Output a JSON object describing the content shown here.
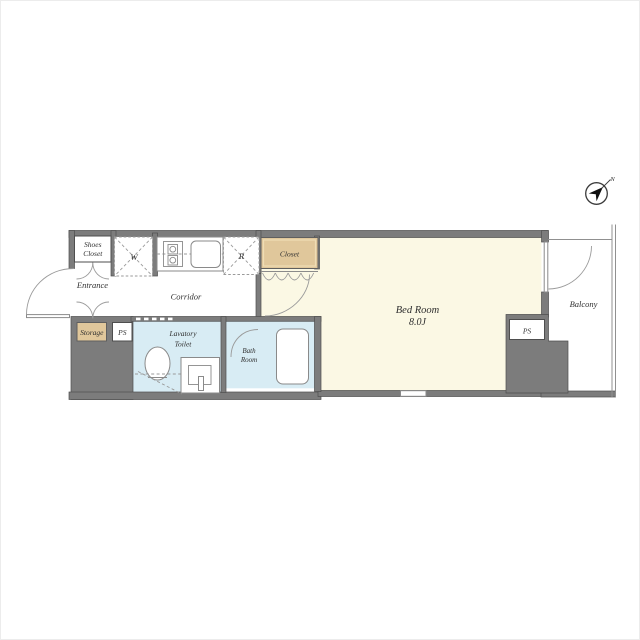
{
  "colors": {
    "wall": "#7c7c7c",
    "wall_edge": "#4e4e4e",
    "room_cream": "#fbf8e4",
    "wet_blue": "#d8ecf4",
    "closet_tan": "#e0c79b",
    "label_ink": "#2f2f2f"
  },
  "plan": {
    "rooms": {
      "shoes_closet": {
        "line1": "Shoes",
        "line2": "Closet"
      },
      "entrance": {
        "label": "Entrance"
      },
      "storage": {
        "label": "Storage"
      },
      "pipe_space_left": {
        "label": "PS"
      },
      "washing_machine": {
        "label": "W"
      },
      "refrigerator": {
        "label": "R"
      },
      "corridor": {
        "label": "Corridor"
      },
      "closet": {
        "label": "Closet"
      },
      "lavatory": {
        "line1": "Lavatory",
        "line2": "Toilet"
      },
      "bath": {
        "line1": "Bath",
        "line2": "Room"
      },
      "bedroom": {
        "line1": "Bed Room",
        "line2": "8.0J"
      },
      "balcony": {
        "label": "Balcony"
      },
      "pipe_space_right": {
        "label": "PS"
      }
    },
    "compass": {
      "north_label": "N"
    }
  }
}
